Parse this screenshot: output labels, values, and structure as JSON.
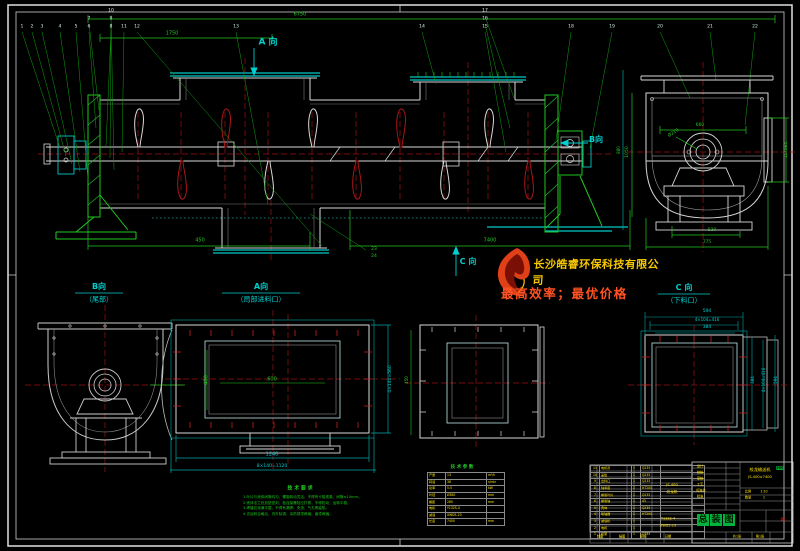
{
  "logo": {
    "company": "长沙皓睿环保科技有限公司",
    "slogan": "最高效率；最优价格",
    "flame_icon": "flame-logo"
  },
  "notes": {
    "title": "技 术 要 求",
    "items": [
      "1.叶片与壳体间隙均匀，螺旋转动灵活，不得有卡阻现象，间隙≤10mm。",
      "2.壳体法兰处加垫密封，各连接螺栓应拧紧，不得松动，运转平稳。",
      "3.焊缝应饱满平整，不得有漏焊、夹渣、气孔等缺陷。",
      "4.试运转合格后，内外除锈，涂防锈漆两遍，面漆两遍。"
    ]
  },
  "params": {
    "title": "技 术 参 数",
    "rows": [
      [
        "产量",
        "13",
        "m³/h"
      ],
      [
        "转速",
        "38",
        "r/min"
      ],
      [
        "功率",
        "5.5",
        "kW"
      ],
      [
        "叶径",
        "Ø380",
        "mm"
      ],
      [
        "螺距",
        "280",
        "mm"
      ],
      [
        "电机",
        "Y132S-4",
        ""
      ],
      [
        "减速",
        "XWD5-23",
        ""
      ],
      [
        "长度",
        "7400",
        "mm"
      ]
    ]
  },
  "bom": {
    "rows": [
      [
        "11",
        "电机罩",
        "1",
        "Q235"
      ],
      [
        "10",
        "盖板",
        "1",
        "Q235"
      ],
      [
        "9",
        "出料口",
        "1",
        "Q235"
      ],
      [
        "8",
        "轴承座",
        "2",
        "HT200"
      ],
      [
        "7",
        "螺旋叶片",
        "1",
        "Q235"
      ],
      [
        "6",
        "螺旋轴",
        "1",
        "45"
      ],
      [
        "5",
        "壳体",
        "1",
        "Q235"
      ],
      [
        "4",
        "联轴器",
        "1",
        "HT200"
      ],
      [
        "3",
        "减速机",
        "1",
        ""
      ],
      [
        "2",
        "电机",
        "1",
        ""
      ],
      [
        "1",
        "机架",
        "1",
        "Q235"
      ]
    ]
  },
  "title_block": {
    "title_chars": [
      "总",
      "装",
      "图"
    ],
    "chip_x0": 697,
    "chip_y": 514
  },
  "labels": [
    {
      "t": "6750",
      "x": 300,
      "y": 15,
      "c": "g",
      "s": 5
    },
    {
      "t": "1750",
      "x": 172,
      "y": 34,
      "c": "g",
      "s": 5
    },
    {
      "t": "A 向",
      "x": 268,
      "y": 43,
      "c": "c",
      "s": 9,
      "b": 1
    },
    {
      "t": "B向",
      "x": 596,
      "y": 140,
      "c": "c",
      "s": 8,
      "b": 1
    },
    {
      "t": "C 向",
      "x": 468,
      "y": 262,
      "c": "c",
      "s": 8,
      "b": 1
    },
    {
      "t": "450",
      "x": 200,
      "y": 241,
      "c": "g",
      "s": 5
    },
    {
      "t": "7400",
      "x": 490,
      "y": 241,
      "c": "g",
      "s": 5
    },
    {
      "t": "23",
      "x": 374,
      "y": 250,
      "c": "g",
      "s": 4.5
    },
    {
      "t": "24",
      "x": 374,
      "y": 257,
      "c": "g",
      "s": 4.5
    },
    {
      "t": "660",
      "x": 700,
      "y": 126,
      "c": "g",
      "s": 4.5
    },
    {
      "t": "Ø219",
      "x": 674,
      "y": 134,
      "c": "g",
      "s": 4.5,
      "r": -32
    },
    {
      "t": "520",
      "x": 712,
      "y": 231,
      "c": "g",
      "s": 4.5
    },
    {
      "t": "775",
      "x": 707,
      "y": 243,
      "c": "g",
      "s": 4.5
    },
    {
      "t": "1050",
      "x": 628,
      "y": 152,
      "c": "g",
      "s": 4.5,
      "r": -90
    },
    {
      "t": "1170±5",
      "x": 786,
      "y": 150,
      "c": "g",
      "s": 4,
      "r": -90
    },
    {
      "t": "880",
      "x": 619,
      "y": 150,
      "c": "g",
      "s": 4,
      "r": -90
    },
    {
      "t": "B向",
      "x": 99,
      "y": 287,
      "c": "c",
      "s": 8,
      "b": 1
    },
    {
      "t": "（尾部）",
      "x": 99,
      "y": 300,
      "c": "c",
      "s": 7
    },
    {
      "t": "A向",
      "x": 261,
      "y": 287,
      "c": "c",
      "s": 8,
      "b": 1
    },
    {
      "t": "（局部进料口）",
      "x": 261,
      "y": 300,
      "c": "c",
      "s": 7
    },
    {
      "t": "600",
      "x": 272,
      "y": 380,
      "c": "g",
      "s": 5
    },
    {
      "t": "400",
      "x": 207,
      "y": 380,
      "c": "g",
      "s": 5,
      "r": -90
    },
    {
      "t": "1240",
      "x": 272,
      "y": 455,
      "c": "c",
      "s": 5
    },
    {
      "t": "8×140=1120",
      "x": 272,
      "y": 467,
      "c": "c",
      "s": 4.5
    },
    {
      "t": "4×140=560",
      "x": 391,
      "y": 379,
      "c": "c",
      "s": 4.5,
      "r": -90
    },
    {
      "t": "450",
      "x": 407,
      "y": 380,
      "c": "g",
      "s": 4,
      "r": -90
    },
    {
      "t": "C 向",
      "x": 684,
      "y": 288,
      "c": "c",
      "s": 8,
      "b": 1
    },
    {
      "t": "（下料口）",
      "x": 684,
      "y": 301,
      "c": "c",
      "s": 7
    },
    {
      "t": "594",
      "x": 707,
      "y": 312,
      "c": "c",
      "s": 4.5
    },
    {
      "t": "4×104=416",
      "x": 707,
      "y": 320,
      "c": "c",
      "s": 4
    },
    {
      "t": "384",
      "x": 707,
      "y": 328,
      "c": "c",
      "s": 4.5
    },
    {
      "t": "384",
      "x": 753,
      "y": 380,
      "c": "c",
      "s": 4,
      "r": -90
    },
    {
      "t": "4×104=416",
      "x": 764,
      "y": 380,
      "c": "c",
      "s": 4,
      "r": -90
    },
    {
      "t": "594",
      "x": 776,
      "y": 380,
      "c": "c",
      "s": 4,
      "r": -90
    },
    {
      "t": "技 术 要 求",
      "x": 300,
      "y": 489,
      "c": "g",
      "s": 5,
      "b": 1
    },
    {
      "t": "技 术 参 数",
      "x": 462,
      "y": 468,
      "c": "g",
      "s": 4.5,
      "b": 1
    },
    {
      "t": "设计",
      "x": 700,
      "y": 467,
      "c": "y",
      "s": 3.2
    },
    {
      "t": "校核",
      "x": 700,
      "y": 473,
      "c": "y",
      "s": 3.2
    },
    {
      "t": "审核",
      "x": 700,
      "y": 479,
      "c": "y",
      "s": 3.2
    },
    {
      "t": "工艺",
      "x": 700,
      "y": 485,
      "c": "y",
      "s": 3.2
    },
    {
      "t": "标准化",
      "x": 701,
      "y": 491,
      "c": "y",
      "s": 3.2
    },
    {
      "t": "批准",
      "x": 700,
      "y": 497,
      "c": "y",
      "s": 3.2
    },
    {
      "t": "绞龙输送机",
      "x": 760,
      "y": 470,
      "c": "y",
      "s": 4.2
    },
    {
      "t": "JS-400×7400",
      "x": 760,
      "y": 478,
      "c": "y",
      "s": 3.6
    },
    {
      "t": "比例",
      "x": 748,
      "y": 492,
      "c": "y",
      "s": 3.2
    },
    {
      "t": "1:10",
      "x": 764,
      "y": 492,
      "c": "y",
      "s": 3.2
    },
    {
      "t": "数量",
      "x": 748,
      "y": 498,
      "c": "y",
      "s": 3.2
    },
    {
      "t": "1",
      "x": 764,
      "y": 498,
      "c": "y",
      "s": 3.2
    },
    {
      "t": "HR",
      "x": 780,
      "y": 468,
      "c": "k",
      "s": 4,
      "chip": 1
    },
    {
      "t": "01",
      "x": 783,
      "y": 520,
      "c": "r",
      "s": 4
    },
    {
      "t": "共1张",
      "x": 737,
      "y": 537,
      "c": "y",
      "s": 3.2
    },
    {
      "t": "第1张",
      "x": 760,
      "y": 537,
      "c": "y",
      "s": 3.2
    },
    {
      "t": "制图",
      "x": 600,
      "y": 537,
      "c": "y",
      "s": 3.2
    },
    {
      "t": "描图",
      "x": 622,
      "y": 537,
      "c": "y",
      "s": 3.2
    },
    {
      "t": "审核",
      "x": 643,
      "y": 537,
      "c": "y",
      "s": 3.2
    },
    {
      "t": "日期",
      "x": 668,
      "y": 537,
      "c": "y",
      "s": 3.2
    },
    {
      "t": "JS-400",
      "x": 672,
      "y": 486,
      "c": "y",
      "s": 3.6
    },
    {
      "t": "绞龙机",
      "x": 672,
      "y": 493,
      "c": "y",
      "s": 3.6
    },
    {
      "t": "Y132S-4",
      "x": 668,
      "y": 519,
      "c": "y",
      "s": 3.4
    },
    {
      "t": "XWD5-23",
      "x": 668,
      "y": 526,
      "c": "y",
      "s": 3.4
    }
  ],
  "balloons": [
    {
      "t": "1",
      "x": 22,
      "y": 28
    },
    {
      "t": "2",
      "x": 32,
      "y": 28
    },
    {
      "t": "3",
      "x": 42,
      "y": 28
    },
    {
      "t": "4",
      "x": 60,
      "y": 28
    },
    {
      "t": "5",
      "x": 76,
      "y": 28
    },
    {
      "t": "6",
      "x": 89,
      "y": 28
    },
    {
      "t": "7",
      "x": 89,
      "y": 20
    },
    {
      "t": "8",
      "x": 111,
      "y": 28
    },
    {
      "t": "9",
      "x": 111,
      "y": 20
    },
    {
      "t": "10",
      "x": 111,
      "y": 12
    },
    {
      "t": "11",
      "x": 124,
      "y": 28
    },
    {
      "t": "12",
      "x": 137,
      "y": 28
    },
    {
      "t": "13",
      "x": 236,
      "y": 28
    },
    {
      "t": "14",
      "x": 422,
      "y": 28
    },
    {
      "t": "15",
      "x": 485,
      "y": 28
    },
    {
      "t": "16",
      "x": 485,
      "y": 20
    },
    {
      "t": "17",
      "x": 485,
      "y": 12
    },
    {
      "t": "18",
      "x": 571,
      "y": 28,
      "c": "g"
    },
    {
      "t": "19",
      "x": 612,
      "y": 28
    },
    {
      "t": "20",
      "x": 660,
      "y": 28
    },
    {
      "t": "21",
      "x": 710,
      "y": 28
    },
    {
      "t": "22",
      "x": 755,
      "y": 28
    }
  ],
  "colors": {
    "line": "#d8d8d8",
    "cyan": "#00c8c8",
    "green": "#21c721",
    "centerline": "#a01010",
    "bolt_red": "#cc2020",
    "yellow": "#ffe400",
    "logo_orange": "#e04018",
    "slogan": "#ff5222",
    "chip_green": "#00b33c"
  }
}
